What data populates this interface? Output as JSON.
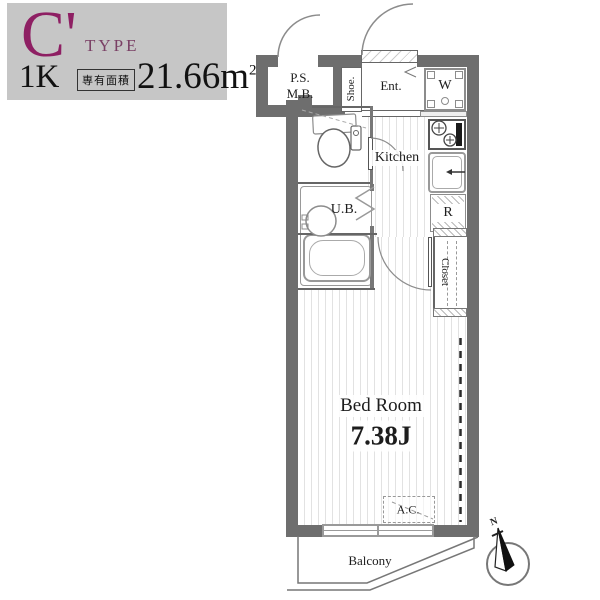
{
  "header": {
    "type_letter": "C'",
    "type_word": "TYPE",
    "layout": "1K",
    "area_label": "専有面積",
    "area_value": "21.66",
    "area_unit": "m",
    "area_unit_sup": "2"
  },
  "labels": {
    "ps": "P.S.",
    "mb": "M.B.",
    "shoe": "Shoe.",
    "entrance": "Ent.",
    "washer": "W",
    "kitchen": "Kitchen",
    "unit_bath": "U.B.",
    "refrigerator": "R",
    "closet": "Closet",
    "bedroom_name": "Bed Room",
    "bedroom_size": "7.38J",
    "ac": "A.C.",
    "balcony": "Balcony",
    "compass_north": "N"
  },
  "colors": {
    "wall": "#6e6e6e",
    "header_bg": "#c6c6c6",
    "type_magenta": "#8e1f63",
    "type_purple": "#7a4065",
    "fixture_line": "#999999",
    "floor_stripe": "#e2e2e2"
  }
}
